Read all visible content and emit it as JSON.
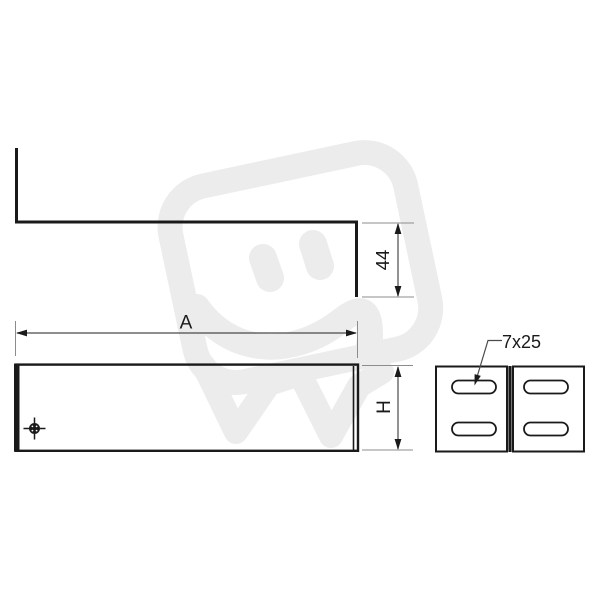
{
  "drawing": {
    "type": "technical-drawing",
    "views": {
      "top": "z-profile",
      "front": "bracket-body",
      "side": "end-plates-with-slots"
    },
    "labels": {
      "width_dim": "A",
      "height_dim": "H",
      "flange_dim": "44",
      "slot_dim": "7x25"
    }
  },
  "colors": {
    "line": "#1a1a1a",
    "dimension": "#4a4a4a",
    "extension": "#8c8c8c",
    "watermark": "#ececec",
    "background": "#ffffff"
  }
}
